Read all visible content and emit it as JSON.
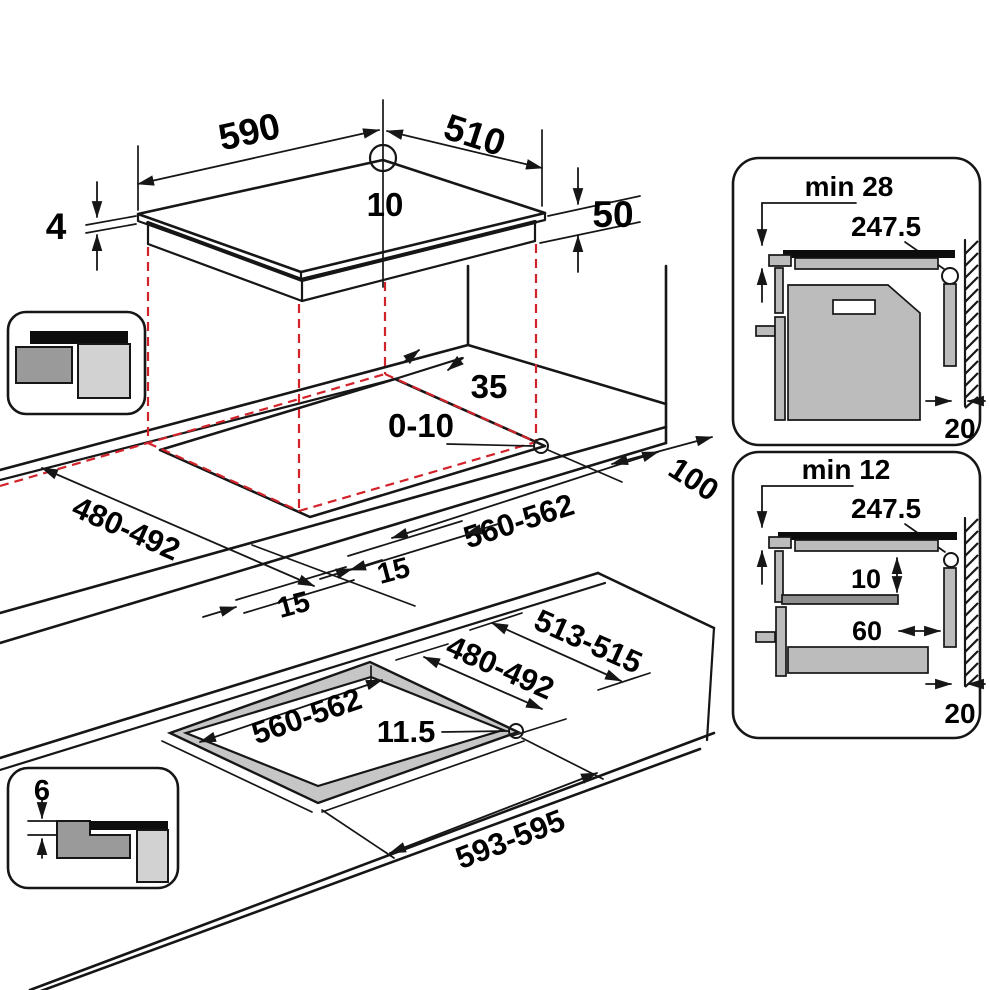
{
  "title": "Built-in hob installation dimensions diagram",
  "colors": {
    "line_black": "#161616",
    "projection_red": "#d2232a",
    "gray_dark": "#9a9a9a",
    "gray_light": "#d2d2d2",
    "gray_mid": "#bcbcbc"
  },
  "views": {
    "hob": {
      "width": "590",
      "depth": "510",
      "corner_radius": "10",
      "glass_thickness": "4",
      "body_height": "50"
    },
    "worktop_cutout": {
      "rear_gap": "35",
      "corner_radius": "0-10",
      "side_clearance": "100",
      "depth": "480-492",
      "width": "560-562",
      "front_gap": "15",
      "glass_overlap": "15"
    },
    "flush_cutout": {
      "ledge_depth": "513-515",
      "depth": "480-492",
      "width": "560-562",
      "corner_radius": "11.5",
      "ledge_width": "593-595"
    },
    "flush_section": {
      "rebate_depth": "6"
    },
    "oven_section": {
      "clearance": "min 28",
      "appliance_height": "247.5",
      "rear_gap": "20"
    },
    "drawer_section": {
      "clearance": "min 12",
      "appliance_height": "247.5",
      "shelf_gap": "10",
      "vent_width": "60",
      "rear_gap": "20"
    }
  }
}
